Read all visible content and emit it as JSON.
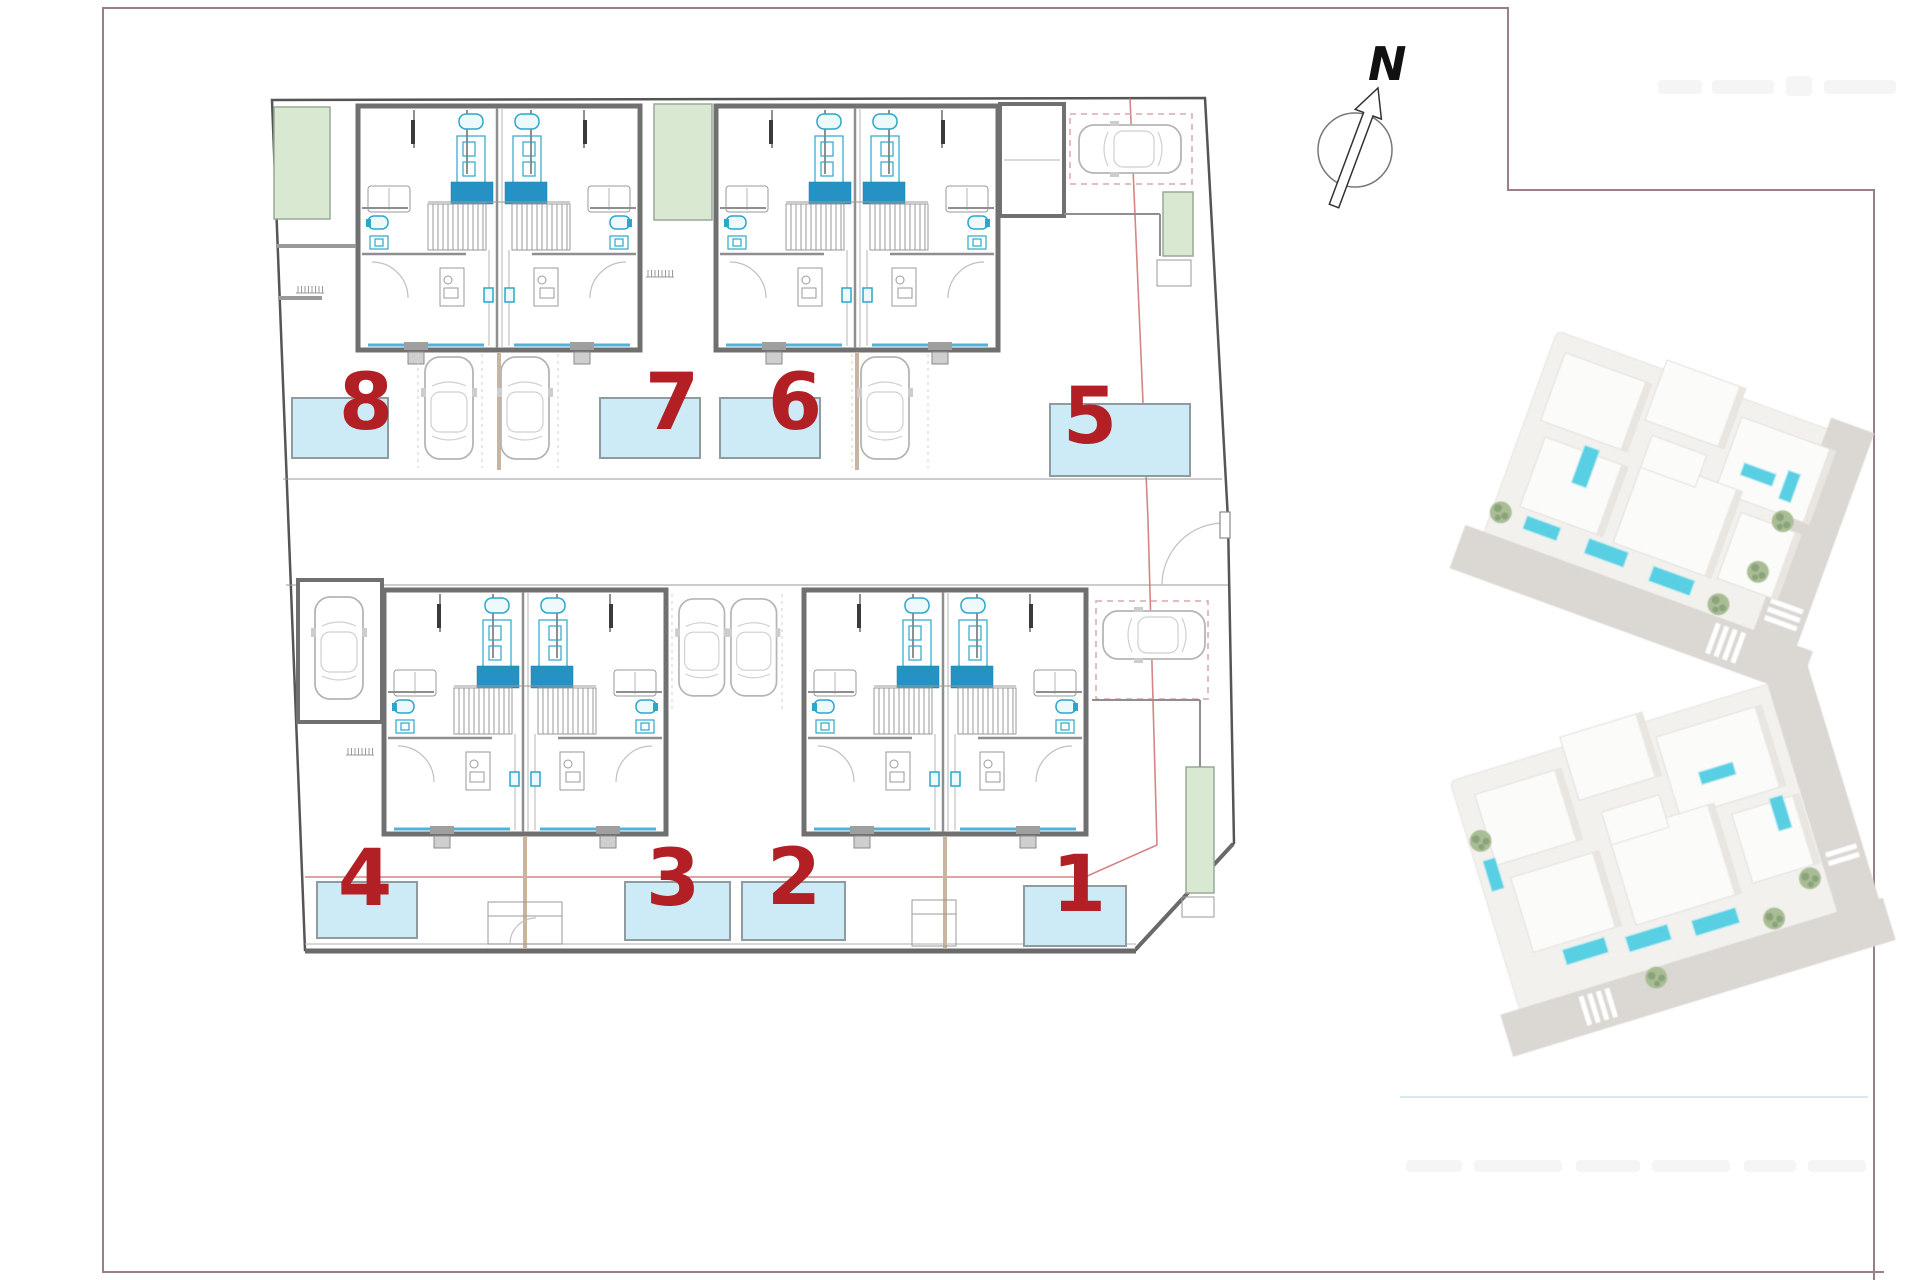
{
  "page": {
    "background": "#ffffff",
    "border_color": "#9b7f88"
  },
  "compass": {
    "label": "N"
  },
  "site_plan": {
    "number_color": "#b21f24",
    "pool_fill": "#cdebf7",
    "pool_border": "#8f9b9e",
    "green_fill": "#d9e8d0",
    "accent_blue": "#2692c4",
    "fixture_cyan": "#2ba7cc",
    "wall_gray": "#707070",
    "glass_blue": "#4fb3d9",
    "red_line": "#cf6f6f",
    "units": [
      {
        "id": "villa-8",
        "number": "8"
      },
      {
        "id": "villa-7",
        "number": "7"
      },
      {
        "id": "villa-6",
        "number": "6"
      },
      {
        "id": "villa-5",
        "number": "5"
      },
      {
        "id": "villa-4",
        "number": "4"
      },
      {
        "id": "villa-3",
        "number": "3"
      },
      {
        "id": "villa-2",
        "number": "2"
      },
      {
        "id": "villa-1",
        "number": "1"
      }
    ]
  }
}
